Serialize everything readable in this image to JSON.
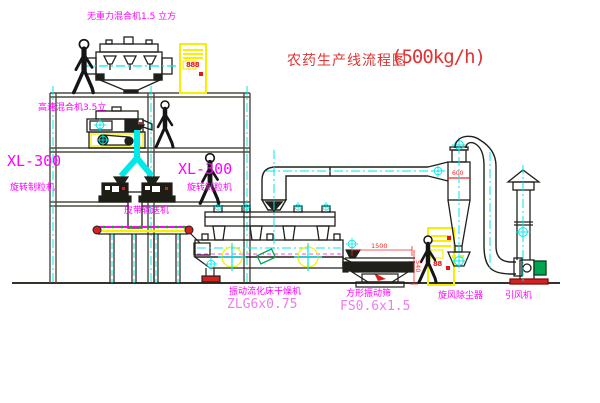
{
  "title": {
    "name": "农药生产线流程图",
    "capacity": "(500kg/h)"
  },
  "labels": {
    "gravity_mixer": "无重力混合机1.5 立方",
    "high_speed_mixer": "高速混合机3.5立",
    "granulator_left": {
      "model": "XL-300",
      "name": "旋转制粒机"
    },
    "granulator_right": {
      "model": "XL-300",
      "name": "旋转制粒机"
    },
    "belt_conveyor": "皮带输送机",
    "dryer": {
      "name": "振动流化床干燥机",
      "model": "ZLG6x0.75"
    },
    "sieve": {
      "name": "方形振动筛",
      "model": "FS0.6x1.5"
    },
    "cyclone": "旋风除尘器",
    "fan": "引风机"
  },
  "dimensions": {
    "sieve_length": "1500",
    "sieve_height": "540",
    "cyclone_diameter": "600"
  },
  "cabinets": {
    "cabinet_top": {
      "display": "888"
    },
    "cabinet_right": {
      "display": "88"
    }
  },
  "colors": {
    "label_magenta": "#ff00ff",
    "model_magenta": "#ee7bee",
    "title_red": "#e03333",
    "dimension_red": "#ff2222",
    "centerline_cyan": "#00e8e8",
    "cabinet_yellow": "#f8ef00",
    "structure_dark": "#4b4b41",
    "belt_green": "#00b400",
    "base_red": "#d42222",
    "motor_green": "#00a550"
  }
}
